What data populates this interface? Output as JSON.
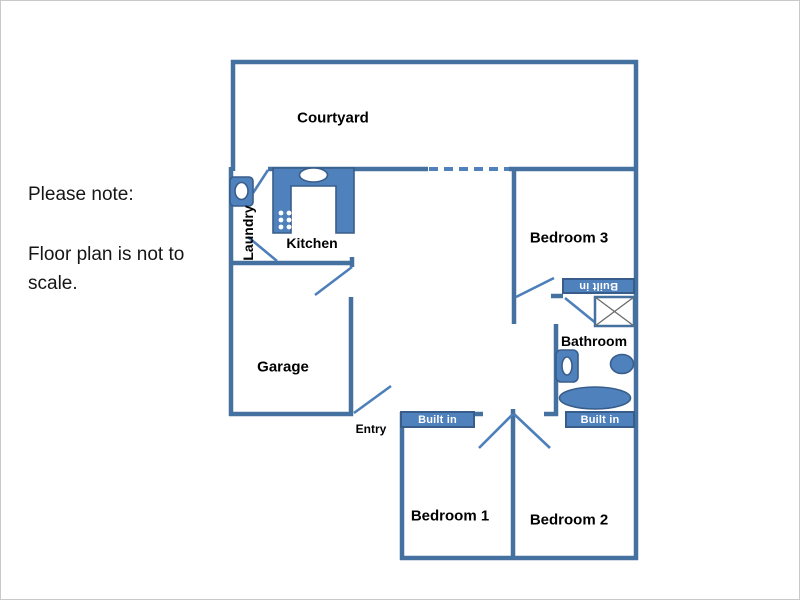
{
  "note": {
    "line1": "Please note:",
    "line2": "Floor plan is not to scale."
  },
  "rooms": {
    "courtyard": "Courtyard",
    "laundry": "Laundry",
    "kitchen": "Kitchen",
    "garage": "Garage",
    "entry": "Entry",
    "bedroom1": "Bedroom 1",
    "bedroom2": "Bedroom 2",
    "bedroom3": "Bedroom 3",
    "bathroom": "Bathroom"
  },
  "closets": {
    "bedroom1": "Built in",
    "bedroom2": "Built in",
    "bedroom3": "Built in"
  },
  "colors": {
    "wall": "#44719f",
    "door_swing": "#4d7fba",
    "dashed_wall": "#4f81bd",
    "fixture_fill": "#4f81bd",
    "fixture_border": "#385d8a",
    "label_text": "#000000",
    "closet_text": "#ffffff",
    "page_border": "#c9c9c9"
  }
}
